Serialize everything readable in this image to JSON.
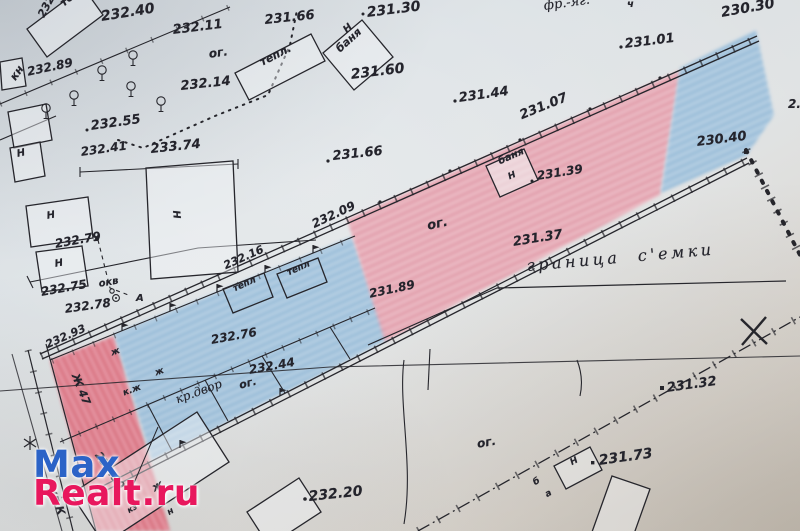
{
  "watermark": {
    "line1": "Max",
    "line2": "Realt.ru",
    "color1": "#2b63c7",
    "color2": "#e8175d"
  },
  "colors": {
    "ink": "#26262c",
    "paper": "#dadfe2",
    "parcel_pink": "#e8a3b0",
    "parcel_red": "#e07585",
    "parcel_blue": "#96bedd"
  },
  "labels": [
    {
      "t": "232.40",
      "x": 100,
      "y": 10,
      "r": -9,
      "s": 14,
      "k": "elev"
    },
    {
      "t": "232.11",
      "x": 172,
      "y": 24,
      "r": -7,
      "s": 13,
      "k": "elev"
    },
    {
      "t": "ог.",
      "x": 208,
      "y": 48,
      "r": -8,
      "s": 12,
      "k": "elev"
    },
    {
      "t": "231.66",
      "x": 264,
      "y": 14,
      "r": -6,
      "s": 13,
      "k": "elev"
    },
    {
      "t": "231.30",
      "x": 366,
      "y": 6,
      "r": -7,
      "s": 14,
      "k": "elev"
    },
    {
      "t": "фр.-яг.",
      "x": 543,
      "y": 0,
      "r": -8,
      "s": 13,
      "k": "script"
    },
    {
      "t": "ч",
      "x": 627,
      "y": 0,
      "r": 0,
      "s": 10,
      "k": "elev"
    },
    {
      "t": "230.30",
      "x": 720,
      "y": 6,
      "r": -10,
      "s": 14,
      "k": "elev"
    },
    {
      "t": "231.01",
      "x": 624,
      "y": 38,
      "r": -7,
      "s": 13,
      "k": "elev"
    },
    {
      "t": "231.60",
      "x": 350,
      "y": 68,
      "r": -7,
      "s": 14,
      "k": "elev"
    },
    {
      "t": "232.14",
      "x": 180,
      "y": 80,
      "r": -6,
      "s": 13,
      "k": "elev"
    },
    {
      "t": "231.44",
      "x": 458,
      "y": 92,
      "r": -8,
      "s": 13,
      "k": "elev"
    },
    {
      "t": "232.89",
      "x": 26,
      "y": 66,
      "r": -12,
      "s": 12,
      "k": "elev"
    },
    {
      "t": "кн",
      "x": 8,
      "y": 76,
      "r": -55,
      "s": 11,
      "k": "elev"
    },
    {
      "t": "232.53",
      "x": 36,
      "y": 14,
      "r": -62,
      "s": 11,
      "k": "elev"
    },
    {
      "t": "тепл",
      "x": 58,
      "y": 0,
      "r": -40,
      "s": 11,
      "k": "elev"
    },
    {
      "t": "тепл.",
      "x": 258,
      "y": 58,
      "r": -27,
      "s": 11,
      "k": "elev"
    },
    {
      "t": "Н",
      "x": 342,
      "y": 28,
      "r": -42,
      "s": 10,
      "k": "elev"
    },
    {
      "t": "баня",
      "x": 334,
      "y": 46,
      "r": -42,
      "s": 11,
      "k": "elev"
    },
    {
      "t": "232.55",
      "x": 90,
      "y": 120,
      "r": -8,
      "s": 13,
      "k": "elev"
    },
    {
      "t": "232.41",
      "x": 80,
      "y": 146,
      "r": -8,
      "s": 12,
      "k": "elev"
    },
    {
      "t": "233.74",
      "x": 150,
      "y": 143,
      "r": -6,
      "s": 13,
      "k": "elev"
    },
    {
      "t": "Н",
      "x": 16,
      "y": 150,
      "r": -12,
      "s": 10,
      "k": "elev"
    },
    {
      "t": "Н",
      "x": 46,
      "y": 212,
      "r": -10,
      "s": 10,
      "k": "elev"
    },
    {
      "t": "Н",
      "x": 54,
      "y": 260,
      "r": -10,
      "s": 10,
      "k": "elev"
    },
    {
      "t": "Н",
      "x": 180,
      "y": 210,
      "r": 85,
      "s": 10,
      "k": "elev"
    },
    {
      "t": "231.66",
      "x": 332,
      "y": 150,
      "r": -6,
      "s": 13,
      "k": "elev"
    },
    {
      "t": "231.07",
      "x": 518,
      "y": 110,
      "r": -22,
      "s": 13,
      "k": "elev"
    },
    {
      "t": "баня",
      "x": 497,
      "y": 158,
      "r": -24,
      "s": 10,
      "k": "elev"
    },
    {
      "t": "Н",
      "x": 507,
      "y": 174,
      "r": -24,
      "s": 9,
      "k": "elev"
    },
    {
      "t": "231.39",
      "x": 536,
      "y": 170,
      "r": -9,
      "s": 12,
      "k": "elev"
    },
    {
      "t": "230.40",
      "x": 696,
      "y": 136,
      "r": -7,
      "s": 13,
      "k": "elev"
    },
    {
      "t": "2.",
      "x": 788,
      "y": 98,
      "r": 0,
      "s": 12,
      "k": "elev"
    },
    {
      "t": "232.09",
      "x": 310,
      "y": 219,
      "r": -25,
      "s": 12,
      "k": "elev"
    },
    {
      "t": "ог.",
      "x": 426,
      "y": 220,
      "r": -12,
      "s": 13,
      "k": "elev"
    },
    {
      "t": "231.37",
      "x": 512,
      "y": 236,
      "r": -9,
      "s": 13,
      "k": "elev"
    },
    {
      "t": "231.89",
      "x": 368,
      "y": 288,
      "r": -12,
      "s": 12,
      "k": "elev"
    },
    {
      "t": "граница с'емки",
      "x": 526,
      "y": 258,
      "r": -5,
      "s": 16,
      "k": "script-wide"
    },
    {
      "t": "232.79",
      "x": 54,
      "y": 238,
      "r": -10,
      "s": 12,
      "k": "elev"
    },
    {
      "t": "окв",
      "x": 98,
      "y": 280,
      "r": -10,
      "s": 10,
      "k": "elev"
    },
    {
      "t": "232.75",
      "x": 40,
      "y": 286,
      "r": -10,
      "s": 12,
      "k": "elev"
    },
    {
      "t": "232.78",
      "x": 64,
      "y": 303,
      "r": -8,
      "s": 12,
      "k": "elev"
    },
    {
      "t": "А",
      "x": 136,
      "y": 294,
      "r": 0,
      "s": 10,
      "k": "elev"
    },
    {
      "t": "232.93",
      "x": 44,
      "y": 340,
      "r": -24,
      "s": 11,
      "k": "elev"
    },
    {
      "t": "232.16",
      "x": 222,
      "y": 261,
      "r": -24,
      "s": 11,
      "k": "elev"
    },
    {
      "t": "тепл",
      "x": 232,
      "y": 286,
      "r": -24,
      "s": 9,
      "k": "elev"
    },
    {
      "t": "тепл",
      "x": 286,
      "y": 270,
      "r": -24,
      "s": 9,
      "k": "elev"
    },
    {
      "t": "232.76",
      "x": 210,
      "y": 334,
      "r": -10,
      "s": 12,
      "k": "elev"
    },
    {
      "t": "232.44",
      "x": 248,
      "y": 364,
      "r": -10,
      "s": 12,
      "k": "elev"
    },
    {
      "t": "ог.",
      "x": 238,
      "y": 380,
      "r": -14,
      "s": 11,
      "k": "elev"
    },
    {
      "t": "кр.двор",
      "x": 174,
      "y": 394,
      "r": -20,
      "s": 12,
      "k": "script"
    },
    {
      "t": "Ж 47",
      "x": 80,
      "y": 372,
      "r": 68,
      "s": 11,
      "k": "elev"
    },
    {
      "t": "к.ж",
      "x": 122,
      "y": 390,
      "r": -20,
      "s": 9,
      "k": "elev"
    },
    {
      "t": "ж",
      "x": 110,
      "y": 350,
      "r": -20,
      "s": 9,
      "k": "elev"
    },
    {
      "t": "ж",
      "x": 154,
      "y": 370,
      "r": -20,
      "s": 9,
      "k": "elev"
    },
    {
      "t": "232.90",
      "x": 102,
      "y": 450,
      "r": 55,
      "s": 11,
      "k": "elev"
    },
    {
      "t": "ул.К",
      "x": 58,
      "y": 486,
      "r": 72,
      "s": 11,
      "k": "elev"
    },
    {
      "t": "ж",
      "x": 150,
      "y": 484,
      "r": -30,
      "s": 11,
      "k": "elev"
    },
    {
      "t": "н",
      "x": 166,
      "y": 510,
      "r": -30,
      "s": 9,
      "k": "elev"
    },
    {
      "t": "кз",
      "x": 126,
      "y": 508,
      "r": -30,
      "s": 8,
      "k": "elev"
    },
    {
      "t": "232.20",
      "x": 308,
      "y": 490,
      "r": -6,
      "s": 14,
      "k": "elev"
    },
    {
      "t": "ог.",
      "x": 476,
      "y": 438,
      "r": -10,
      "s": 12,
      "k": "elev"
    },
    {
      "t": "231.32",
      "x": 666,
      "y": 382,
      "r": -8,
      "s": 13,
      "k": "elev"
    },
    {
      "t": "Н",
      "x": 569,
      "y": 460,
      "r": -28,
      "s": 9,
      "k": "elev"
    },
    {
      "t": "231.73",
      "x": 598,
      "y": 454,
      "r": -8,
      "s": 14,
      "k": "elev"
    },
    {
      "t": "б",
      "x": 532,
      "y": 480,
      "r": -30,
      "s": 9,
      "k": "elev"
    },
    {
      "t": "а",
      "x": 544,
      "y": 492,
      "r": -30,
      "s": 9,
      "k": "elev"
    }
  ]
}
